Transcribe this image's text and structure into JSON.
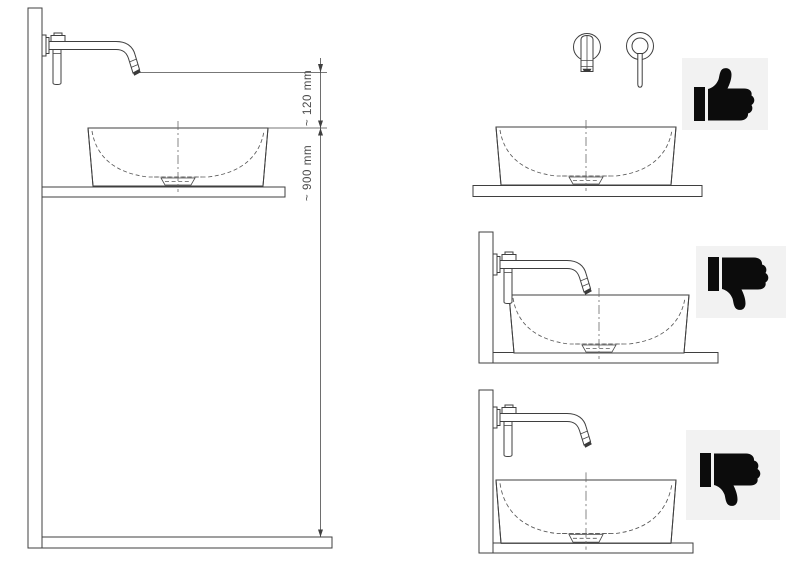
{
  "page": {
    "background": "#ffffff"
  },
  "colors": {
    "line": "#3f3f3f",
    "hatch": "#6e6e6e",
    "dimension_text": "#4b4b4b",
    "badge_background": "#f2f2f2",
    "badge_glyph": "#0c0c0c"
  },
  "left_diagram": {
    "dimension_labels": {
      "spout_to_rim": "~ 120 mm",
      "rim_to_floor": "~ 900 mm"
    }
  },
  "right_diagrams": [
    {
      "view": "front-view",
      "verdict": "correct",
      "icon": "thumbs-up-icon"
    },
    {
      "view": "side-view-spout-too-low",
      "verdict": "incorrect",
      "icon": "thumbs-down-icon"
    },
    {
      "view": "side-view-basin-at-wall",
      "verdict": "incorrect",
      "icon": "thumbs-down-icon"
    }
  ]
}
